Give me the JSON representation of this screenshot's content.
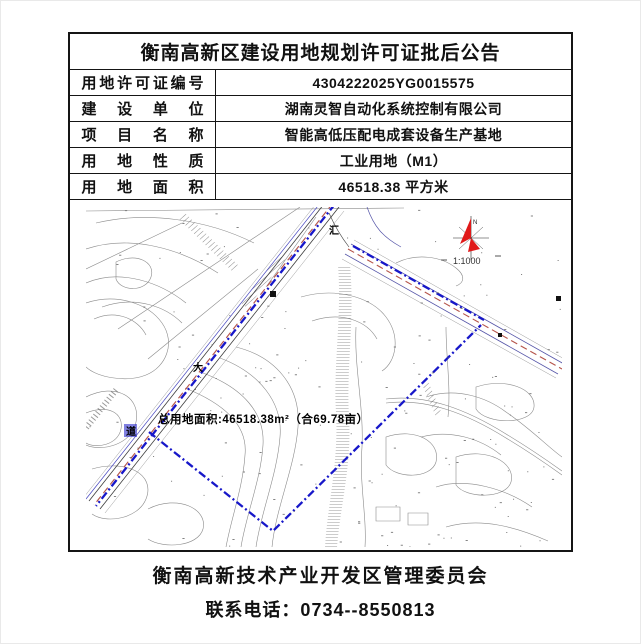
{
  "page": {
    "title": "衡南高新区建设用地规划许可证批后公告",
    "footer_org": "衡南高新技术产业开发区管理委员会",
    "footer_phone": "联系电话：0734--8550813"
  },
  "table": {
    "rows": [
      {
        "label": "用地许可证编号",
        "value": "4304222025YG0015575"
      },
      {
        "label": "建设单位",
        "value": "湖南灵智自动化系统控制有限公司"
      },
      {
        "label": "项目名称",
        "value": "智能高低压配电成套设备生产基地"
      },
      {
        "label": "用地性质",
        "value": "工业用地（M1）"
      },
      {
        "label": "用地面积",
        "value": "46518.38 平方米"
      }
    ]
  },
  "map": {
    "area_label": "总用地面积:46518.38m²（合69.78亩）",
    "scale_label": "1:1000",
    "north_label": "N",
    "labels": {
      "junction": "汇",
      "road_char_1": "大",
      "road_char_2": "道"
    },
    "colors": {
      "boundary_blue": "#1717c9",
      "road_center_red": "#b5544a",
      "north_arrow_red": "#e01919",
      "contour_gray": "#8a8a8a"
    }
  }
}
